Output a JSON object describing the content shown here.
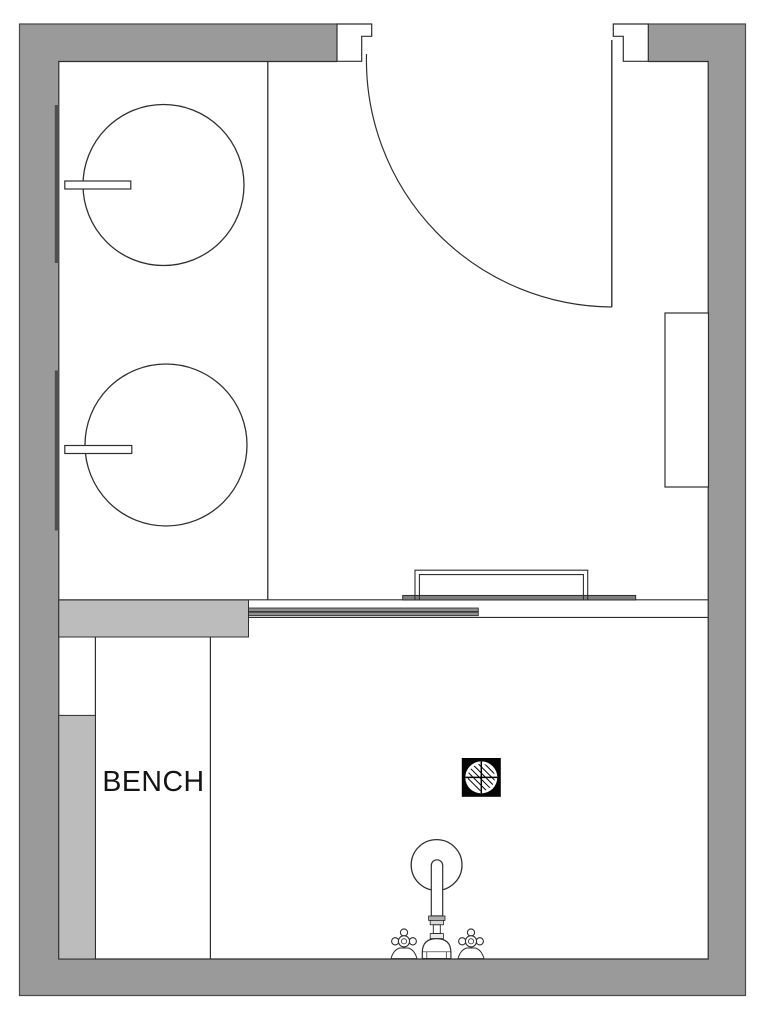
{
  "labels": {
    "bench": "BENCH"
  },
  "theme": {
    "background": "#ffffff",
    "wall": "#9a9a9a",
    "light": "#bcbcbc",
    "panel": "#8f8f8f",
    "bar": "#7f7f7f",
    "bracket": "#4f4f4f",
    "line": "#2f2f2f",
    "drain": "#050505"
  }
}
